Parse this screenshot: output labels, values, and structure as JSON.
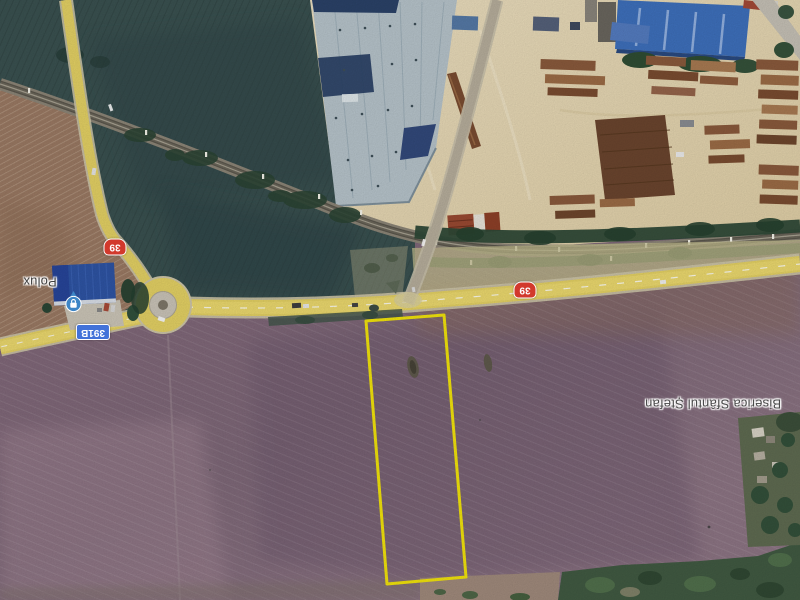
{
  "map": {
    "view": "satellite",
    "labels": {
      "store_name": "Polux",
      "church_name": "Biserica Sfântul Ștefan"
    },
    "badges": {
      "national_road_west": "39",
      "national_road_east": "39",
      "county_road": "391B"
    },
    "icons": {
      "store_icon": "shopping-bag",
      "church_icon": "church"
    },
    "colors": {
      "plot_outline": "#f2e40c",
      "road_overlay": "#e6d465",
      "national_road_badge": "#d2392c",
      "county_road_badge": "#4272d9",
      "store_icon_blue": "#3d85c6"
    }
  }
}
